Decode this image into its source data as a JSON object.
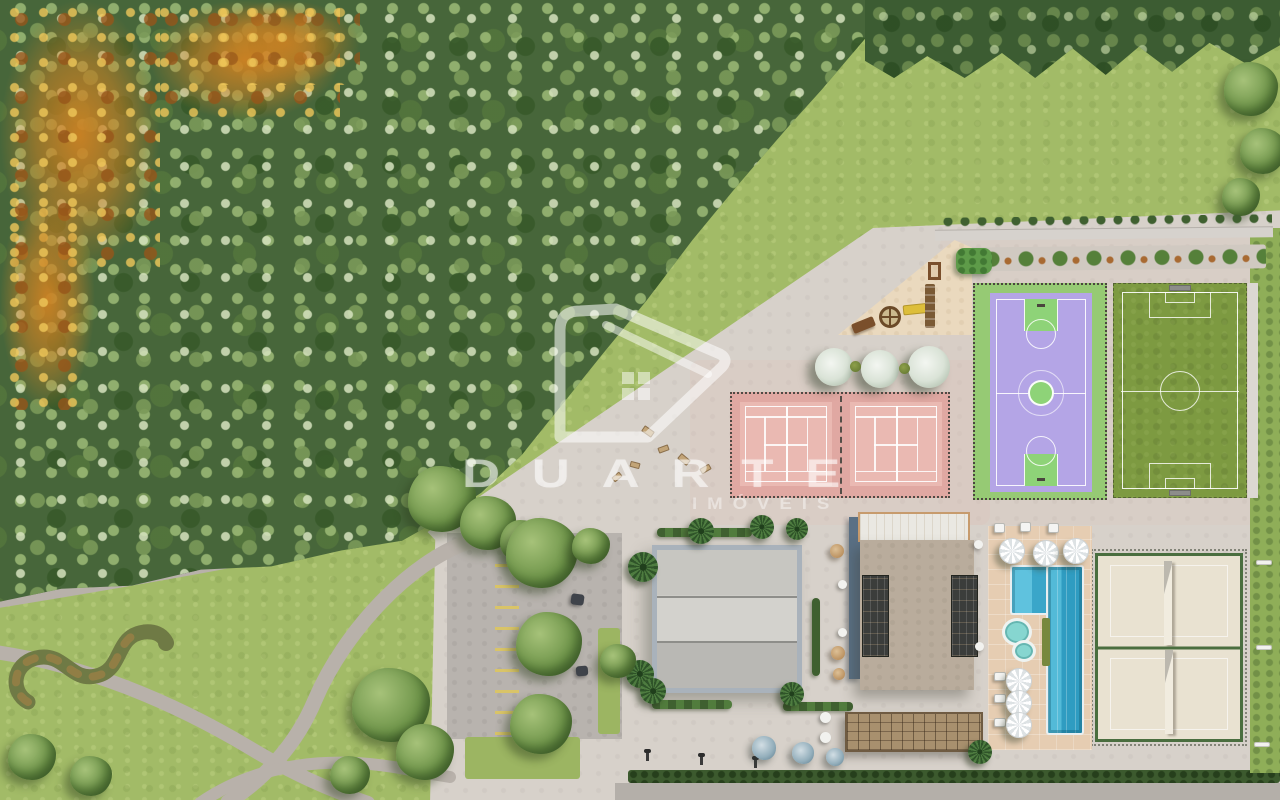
{
  "meta": {
    "type": "aerial-3d-render",
    "subject": "Top-down aerial 3D rendering of a condominium leisure masterplan beside a dense forest"
  },
  "watermark": {
    "title": "DUARTE",
    "subtitle": "IMÓVEIS",
    "logo": "house-d-logo",
    "color": "#ffffff"
  },
  "palette": {
    "forest_green": "#47663a",
    "autumn_orange": "#c88223",
    "lawn_green": "#a2bb67",
    "pavement": "#d7d1ca",
    "parking_gray": "#b8b3ae",
    "tennis_pink": "#eab9b2",
    "basketball_lavender": "#b4a5e6",
    "basketball_green": "#8ed378",
    "soccer_green": "#7d9a41",
    "beach_tennis_sand": "#e9e2d1",
    "beach_tennis_frame": "#4a6e3f",
    "pool_blue": "#3aa6c9",
    "kids_pool_teal": "#86d6d0",
    "deck_tan": "#e6cdb2",
    "gym_roof_gray": "#c7c6c1",
    "clubhouse_roof_tan": "#b9ac9c",
    "pergola_wood": "#a8906e",
    "hedge_green": "#3c5a2e",
    "road_gray": "#b4afa9",
    "parking_stripe_yellow": "#d9c468"
  },
  "regions": [
    {
      "name": "forest",
      "label": "dense forest with autumn-colored trees"
    },
    {
      "name": "lawn",
      "label": "open lawn with curved walking paths"
    },
    {
      "name": "serpentine-garden",
      "label": "s-shaped landscaped berm"
    },
    {
      "name": "parking-lot",
      "label": "parking lot with marked stalls"
    },
    {
      "name": "playground",
      "label": "children playground on sand"
    },
    {
      "name": "fitness-area",
      "label": "outdoor fitness equipment plaza"
    },
    {
      "name": "tennis-courts",
      "label": "two pink tennis courts"
    },
    {
      "name": "basketball-court",
      "label": "lavender and green basketball court"
    },
    {
      "name": "soccer-field",
      "label": "grass soccer field"
    },
    {
      "name": "beach-tennis-courts",
      "label": "two sand beach-tennis courts"
    },
    {
      "name": "swimming-pool",
      "label": "lap pool, kids pool and sun deck with umbrellas"
    },
    {
      "name": "gym-building",
      "label": "covered sports hall with gray roof"
    },
    {
      "name": "clubhouse",
      "label": "clubhouse with glass pergolas"
    },
    {
      "name": "pergola",
      "label": "wood slat pergola lounge"
    },
    {
      "name": "garden-bed",
      "label": "perimeter garden bed with shrubs"
    },
    {
      "name": "perimeter-road",
      "label": "access road with hedge and street lamps"
    }
  ]
}
